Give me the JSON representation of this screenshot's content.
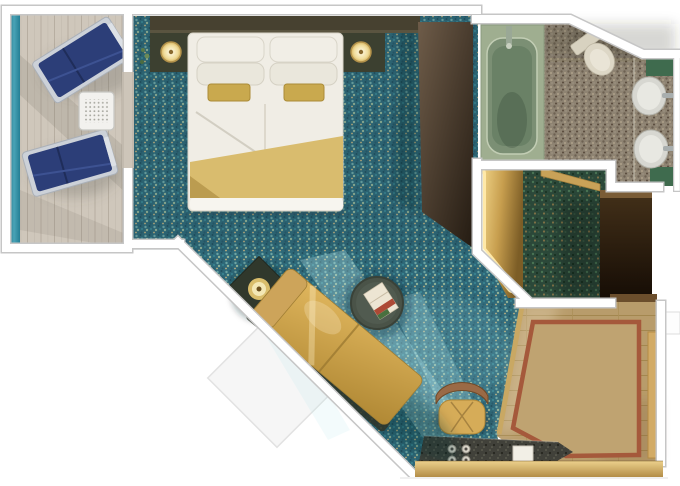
{
  "scene": {
    "kind": "floor-plan",
    "subject": "Cruise ship balcony stateroom, top-down 3D rendered deck plan",
    "text_on_image": "none"
  },
  "rooms": [
    {
      "name": "balcony",
      "furniture": [
        "lounge-chair",
        "lounge-chair",
        "slatted-side-table",
        "railing"
      ]
    },
    {
      "name": "bedroom",
      "furniture": [
        "king-bed",
        "pillows",
        "gold-runner",
        "nightstand-left",
        "nightstand-right",
        "round-lamp-left",
        "round-lamp-right",
        "headboard-panel",
        "tv-wall-panel",
        "plant-sprig"
      ]
    },
    {
      "name": "living-area",
      "furniture": [
        "gold-sofa",
        "sofa-bed-outline",
        "corner-side-table",
        "table-lamp",
        "round-coffee-table",
        "magazine"
      ]
    },
    {
      "name": "bathroom",
      "furniture": [
        "bathtub",
        "toilet",
        "sink-upper",
        "sink-lower",
        "counter-panels"
      ]
    },
    {
      "name": "wardrobe-hall",
      "furniture": [
        "lighted-closet",
        "dark-sliding-panel",
        "bathroom-door-leaf"
      ]
    },
    {
      "name": "entry-foyer",
      "furniture": [
        "wood-floor",
        "border-rug",
        "entry-door"
      ]
    },
    {
      "name": "vanity-area",
      "furniture": [
        "vanity-counter",
        "stool",
        "cup-set",
        "note-pad"
      ]
    }
  ],
  "palette": {
    "wall_white": "#ffffff",
    "wall_edge_gray": "#c6c6c6",
    "balcony_rail_teal": "#2f8ba0",
    "deck_wood": "#cfc7bb",
    "lounger_navy": "#2c3e78",
    "carpet_teal": "#2e6878",
    "carpet_dark_green": "#2b4839",
    "bed_duvet": "#f0ede5",
    "bed_gold": "#d9bc6e",
    "accent_gold": "#d4a952",
    "headboard_brown": "#474130",
    "tv_panel_brown": "#3b2f23",
    "bath_mosaic": "#8e8372",
    "tub_green": "#7b8f74",
    "counter_green": "#3f6b4e",
    "closet_gold": "#d8b465",
    "door_panel_dark": "#2a1c0e",
    "foyer_wood": "#b89c6b",
    "rug_border_red": "#a5593b",
    "vanity_counter_dark": "#41413a"
  }
}
